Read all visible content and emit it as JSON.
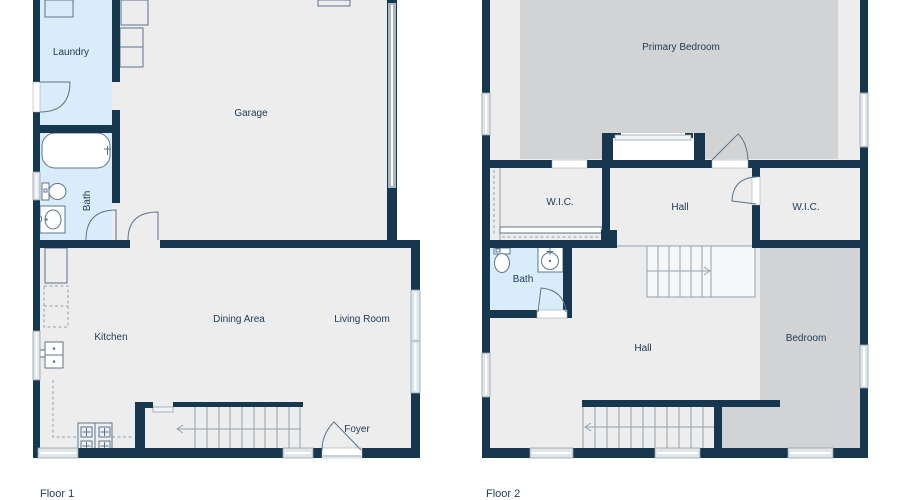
{
  "colors": {
    "wall": "#16374e",
    "floor": "#ededee",
    "wet": "#d9ecfa",
    "carpet": "#d2d3d4",
    "window": "#dfe5e9",
    "line": "#94a2ad",
    "fixture": "#5d748a",
    "text": "#1e3a56"
  },
  "floor1": {
    "title": "Floor 1",
    "labels": {
      "laundry": "Laundry",
      "garage": "Garage",
      "bath": "Bath",
      "kitchen": "Kitchen",
      "dining": "Dining Area",
      "living": "Living Room",
      "foyer": "Foyer"
    }
  },
  "floor2": {
    "title": "Floor 2",
    "labels": {
      "primary": "Primary Bedroom",
      "wic_left": "W.I.C.",
      "hall_upper": "Hall",
      "wic_right": "W.I.C.",
      "bath": "Bath",
      "hall_lower": "Hall",
      "bedroom": "Bedroom"
    }
  }
}
